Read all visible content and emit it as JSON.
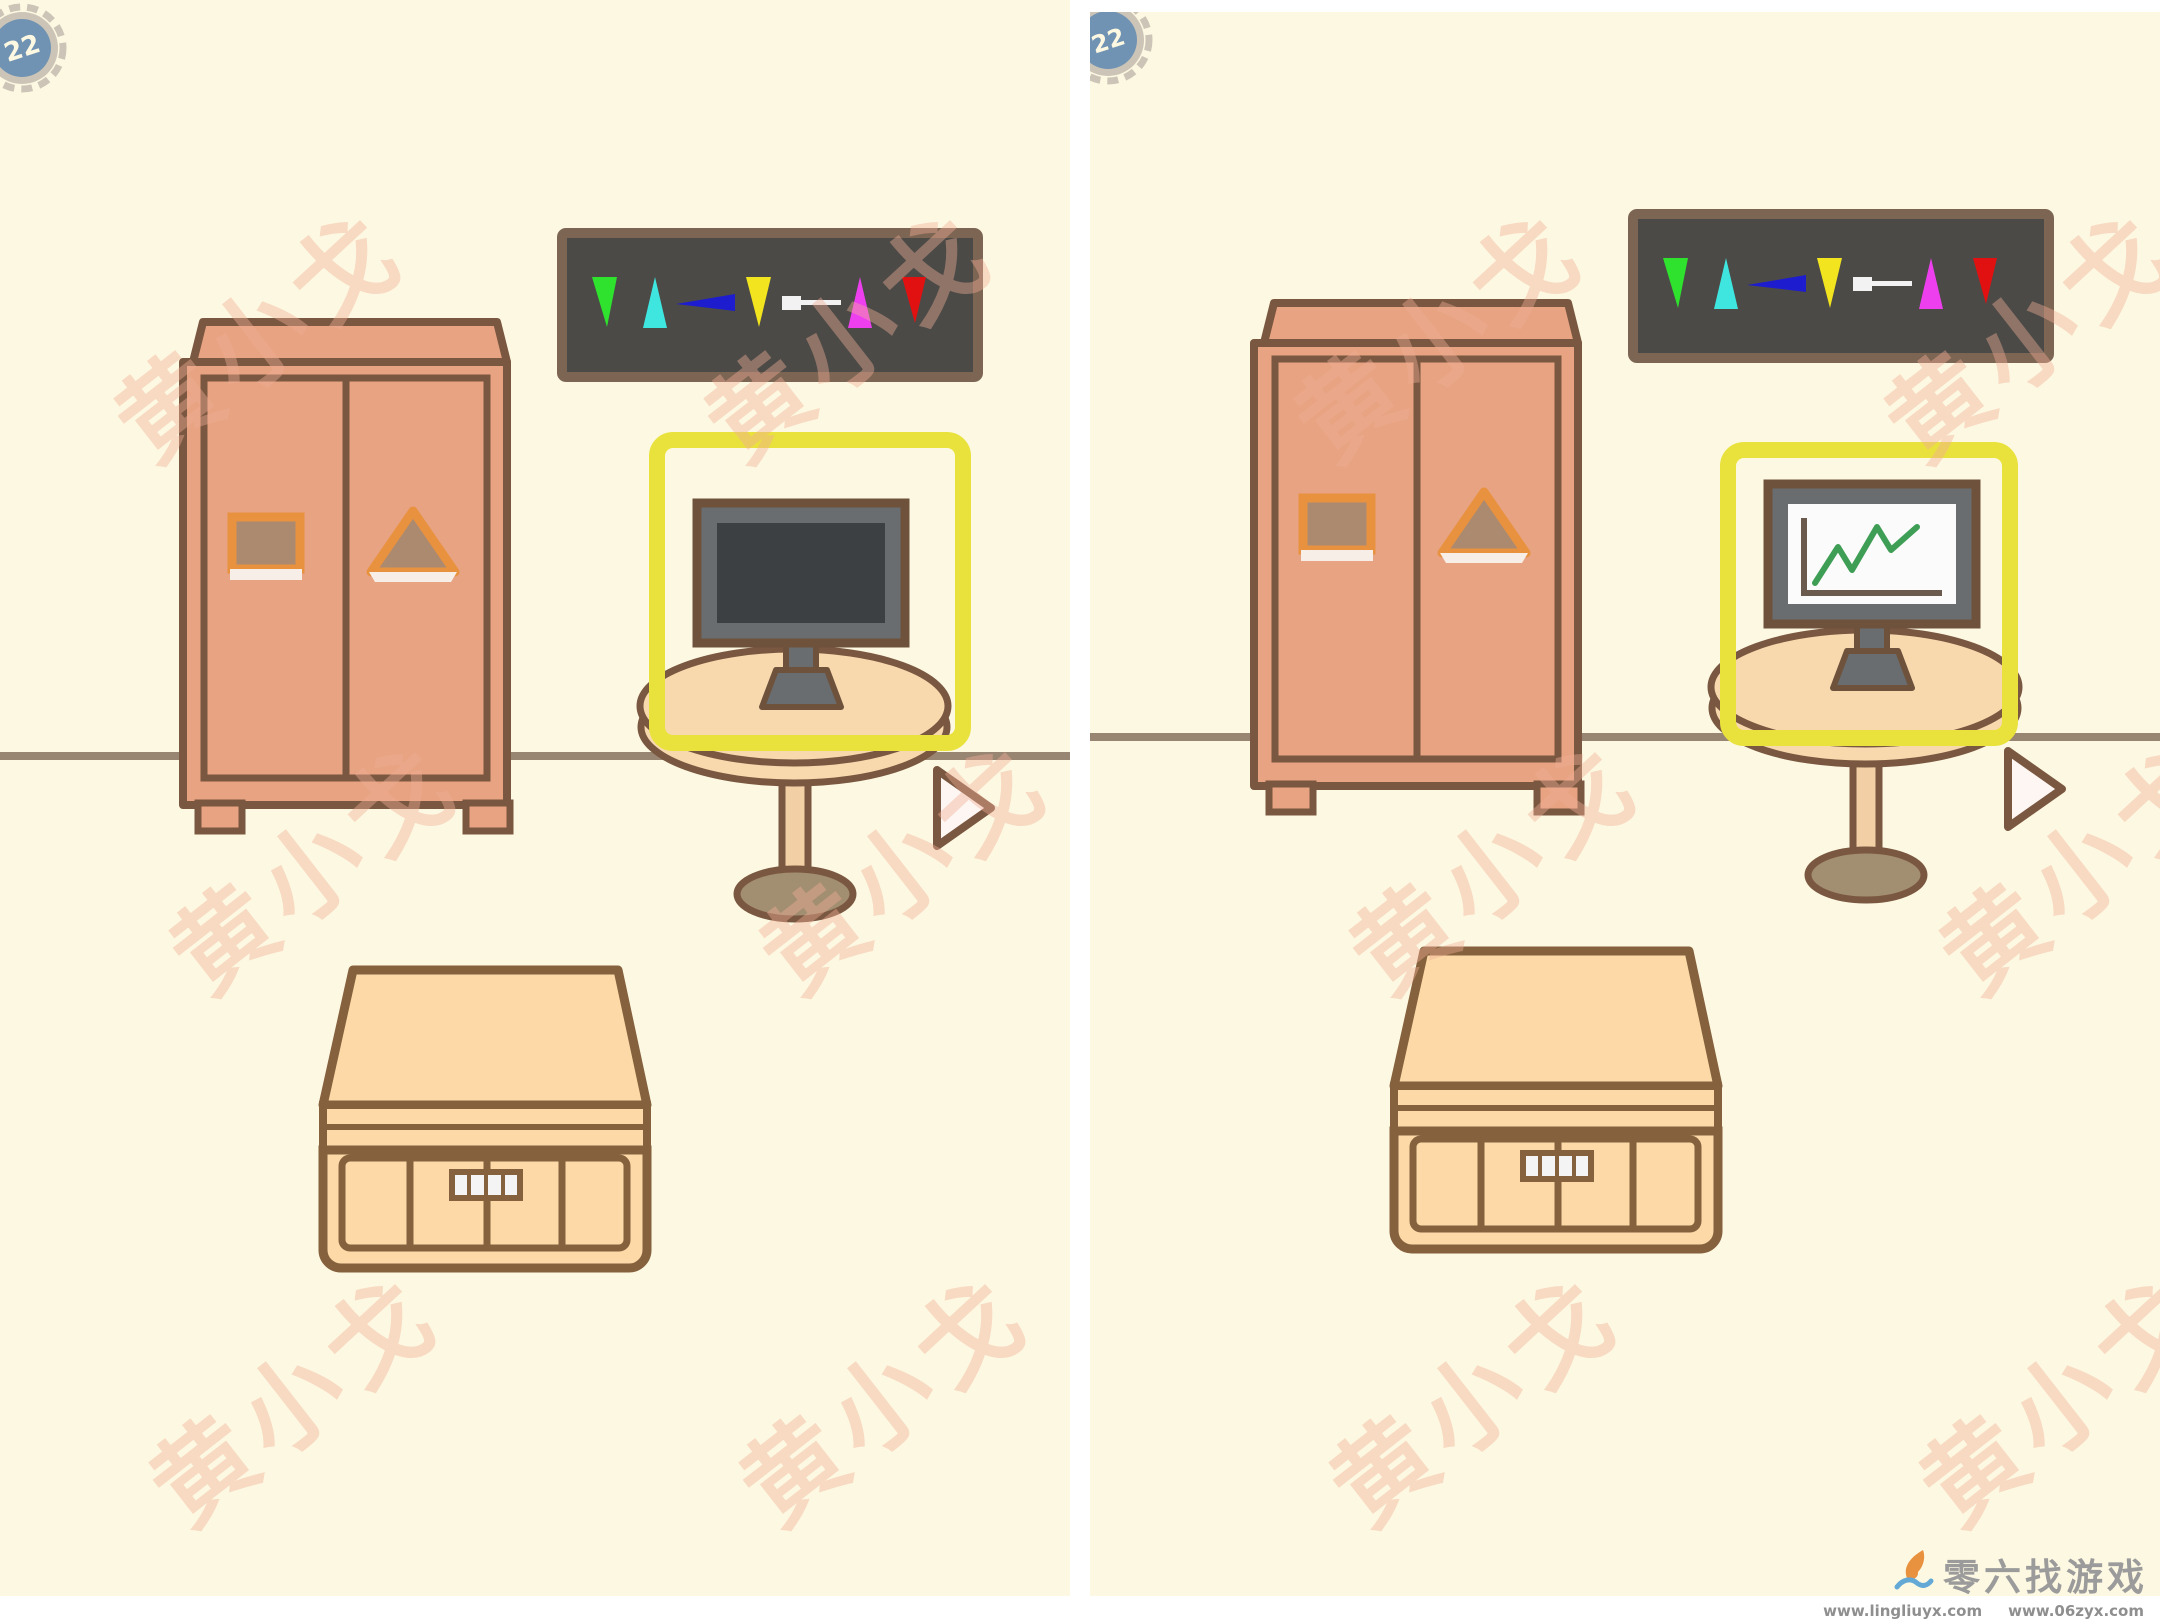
{
  "badge": {
    "level": "22"
  },
  "watermark": {
    "text": "黄小戈",
    "color": "rgba(241,173,149,0.42)"
  },
  "footer": {
    "logo_text": "零六找游戏",
    "url1": "www.lingliuyx.com",
    "url2": "www.06zyx.com"
  },
  "scene": {
    "panel_count": 2,
    "highlight_color": "#e9e23d",
    "wall_color": "#998672",
    "background_color": "#fdf8e2",
    "furniture": {
      "wardrobe": {
        "fill": "#e7a382",
        "outline": "#7a5740",
        "left_door_shape": "square",
        "right_door_shape": "triangle"
      },
      "dart_board": {
        "fill": "#4b4a47",
        "border": "#7d6553",
        "dart_colors": [
          "#2ee22e",
          "#3fe6df",
          "#1d1dcf",
          "#f2e41f",
          "#f2f2f2",
          "#ee3fee",
          "#e21111"
        ]
      },
      "table": {
        "top_fill": "#f8d9ae",
        "base_fill": "#a28e71"
      },
      "monitor": {
        "bezel": "#696d6f",
        "outline": "#6e523c"
      },
      "chest": {
        "fill": "#fcd9a6",
        "outline": "#85613d"
      }
    },
    "difference": {
      "left_monitor_screen": "blank dark screen",
      "right_monitor_screen": "green line chart on white screen",
      "screen_dark": "#3d4043",
      "screen_light": "#fbfbfb",
      "chart_line_color": "#3f9e55"
    }
  }
}
